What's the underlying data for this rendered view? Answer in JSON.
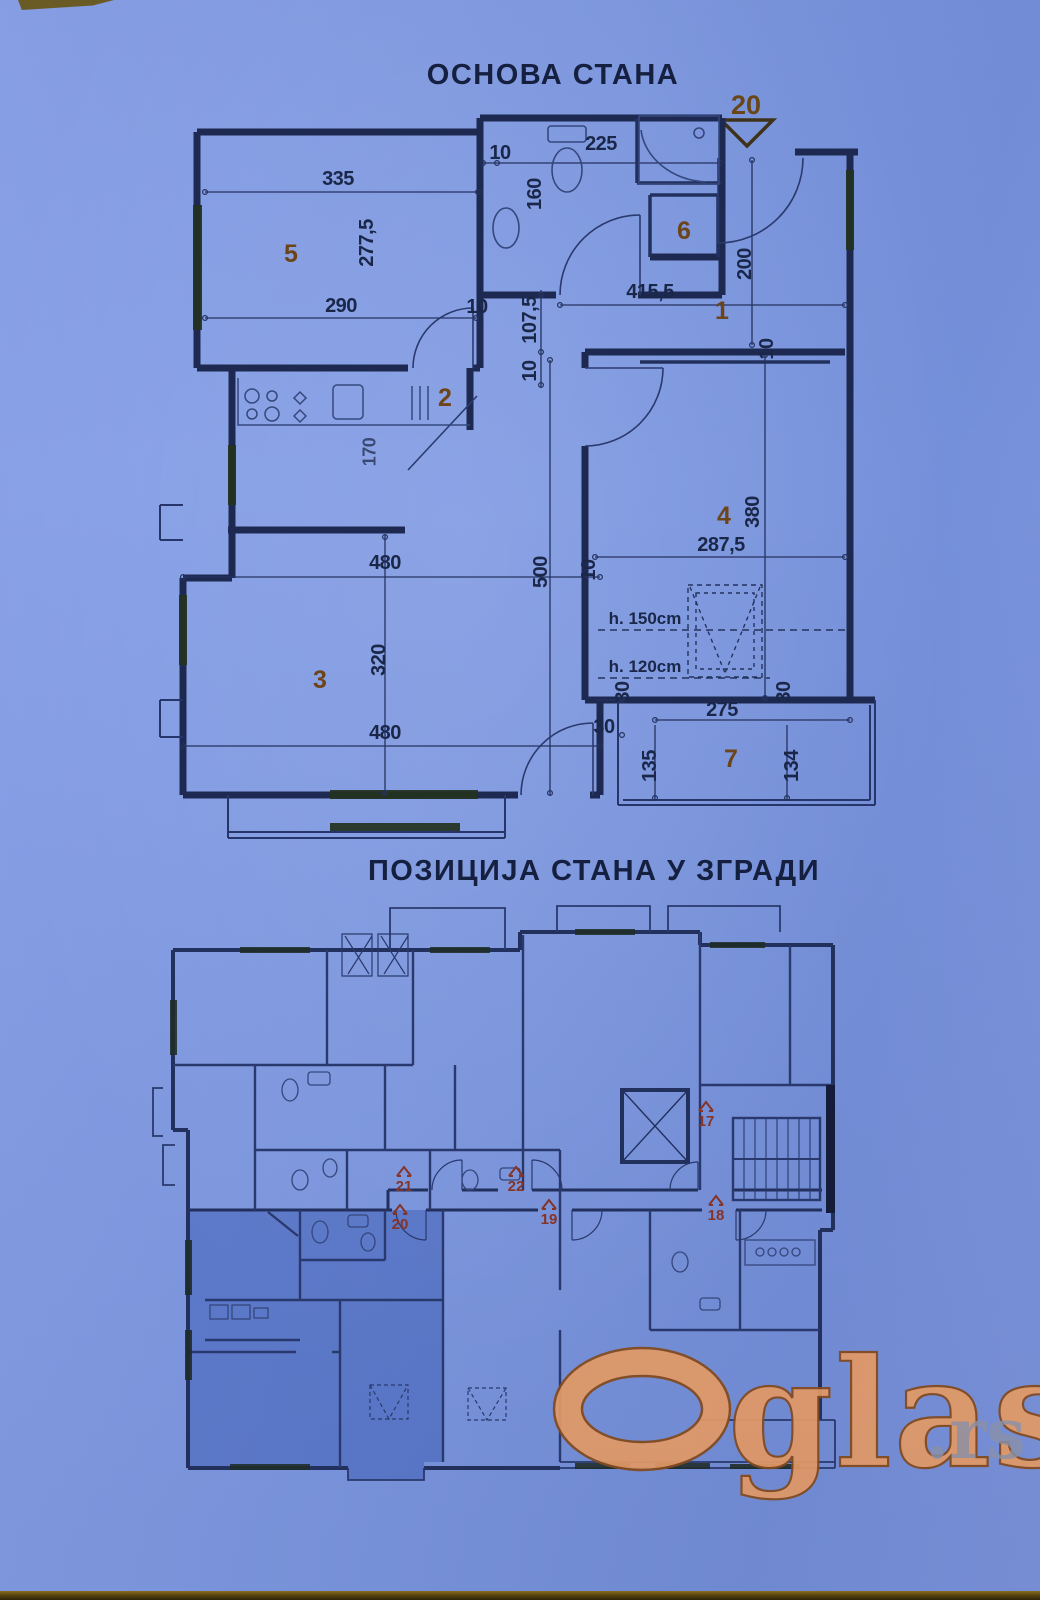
{
  "titles": {
    "upper": "ОСНОВА СТАНА",
    "lower": "ПОЗИЦИЈА СТАНА У ЗГРАДИ"
  },
  "marker": {
    "number": "20"
  },
  "rooms": {
    "n1": "1",
    "n2": "2",
    "n3": "3",
    "n4": "4",
    "n5": "5",
    "n6": "6",
    "n7": "7"
  },
  "heights": {
    "h150": "h. 150cm",
    "h120": "h. 120cm"
  },
  "dims": {
    "d335": "335",
    "d10a": "10",
    "d225": "225",
    "d160": "160",
    "d2775": "277,5",
    "d290": "290",
    "d10b": "10",
    "d1075": "107,5",
    "d10c": "10",
    "d4155": "415,5",
    "d200": "200",
    "d170": "170",
    "d480a": "480",
    "d10d": "10",
    "d500": "500",
    "d320": "320",
    "d480b": "480",
    "d2875": "287,5",
    "d380": "380",
    "d10e": "10",
    "d30a": "30",
    "d30b": "30",
    "d30c": "30",
    "d275": "275",
    "d135": "135",
    "d134": "134"
  },
  "apartments": {
    "a17": "17",
    "a18": "18",
    "a19": "19",
    "a20": "20",
    "a21": "21",
    "a22": "22"
  },
  "watermark": {
    "name": "glasi",
    "initial_o": "O",
    "tld": ".rs"
  },
  "colors": {
    "paper": "#7b97e2",
    "ink": "#1d2950",
    "accent_brown": "#6e4518",
    "apartment_red": "#8a3424",
    "highlight": "#2e4fae",
    "watermark_orange": "#efa066",
    "watermark_outline": "#8a4d1a",
    "watermark_gray": "#9298ab"
  }
}
